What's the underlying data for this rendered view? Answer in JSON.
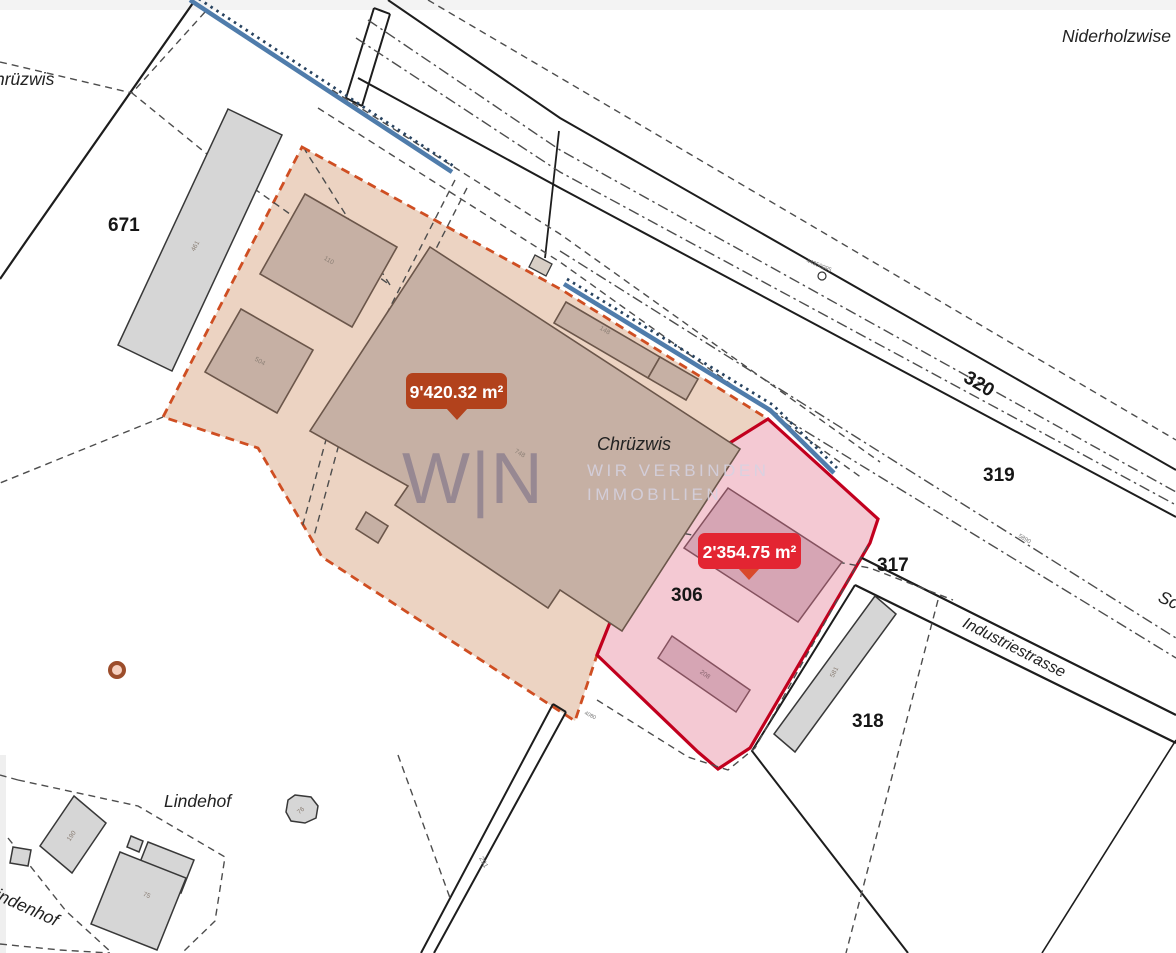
{
  "map_labels": {
    "niderholzwise": "Niderholzwise",
    "chruezwis_partial": "hrüzwis",
    "chruezwis": "Chrüzwis",
    "lindehof": "Lindehof",
    "lindenhof_partial": "indenhof",
    "street_partial": "Sc",
    "industriestrasse": "Industriestrasse"
  },
  "parcel_numbers": {
    "p671": "671",
    "p320": "320",
    "p319": "319",
    "p317": "317",
    "p306": "306",
    "p318": "318"
  },
  "building_numbers": {
    "b461": "461",
    "b110": "110",
    "b504": "504",
    "b148": "148",
    "b748": "748",
    "b208": "208",
    "b581": "581",
    "b190": "190",
    "b75": "75",
    "b76": "76"
  },
  "survey_marks": {
    "railway_point": "44350095",
    "line_5890": "5890",
    "road_291": "291",
    "road_4080": "4080"
  },
  "area_badges": {
    "main": "9'420.32 m²",
    "secondary": "2'354.75 m²"
  },
  "watermark": {
    "logo": "W|N",
    "tagline1": "WIR VERBINDEN",
    "tagline2": "IMMOBILIEN"
  },
  "colors": {
    "parcel_main_fill": "#ecd3c2",
    "parcel_main_border": "#cf4e22",
    "parcel_secondary_fill": "#f4c9d3",
    "parcel_secondary_border": "#c2001e",
    "badge_main": "#b2421c",
    "badge_secondary": "#e32532",
    "badge_pointer": "#d9492b",
    "stream": "#4f7cab"
  }
}
